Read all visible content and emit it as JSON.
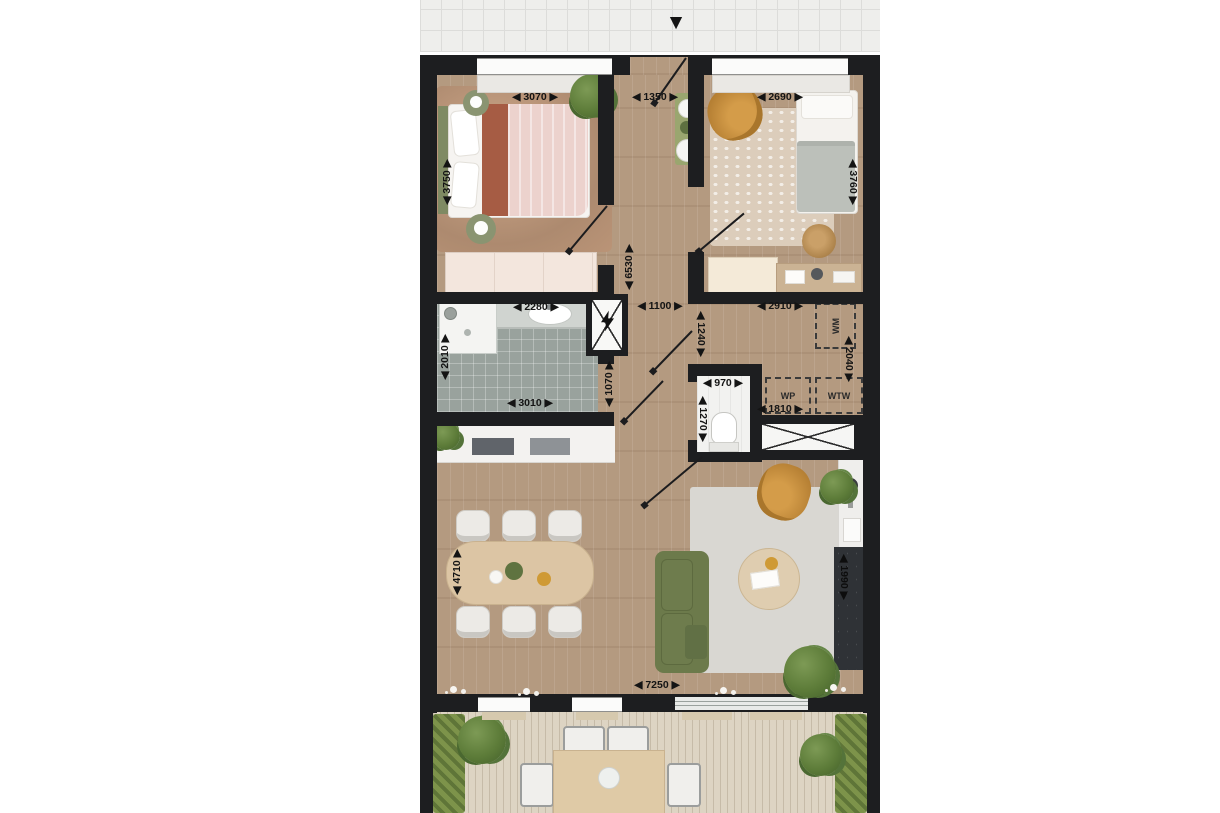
{
  "plan": {
    "entrance_arrow": "▼",
    "dims": {
      "bed1_w": "◀ 3070 ▶",
      "bed1_d": "◀ 3750 ▶",
      "hall_entry": "◀ 1350 ▶",
      "bed2_w": "◀ 2690 ▶",
      "bed2_d": "◀ 3760 ▶",
      "hall_len": "◀ 6530 ▶",
      "bath_top": "◀ 2280 ▶",
      "bath_left": "◀ 2010 ▶",
      "bath_bottom": "◀ 3010 ▶",
      "hall_w1": "◀ 1100 ▶",
      "hall_w2": "◀ 1070 ▶",
      "hall_w3": "◀ 1240 ▶",
      "wc_w": "◀ 970 ▶",
      "wc_d": "◀ 1270 ▶",
      "tech_w": "◀ 2910 ▶",
      "tech_d": "◀ 2040 ▶",
      "tech_bottom": "◀ 1810 ▶",
      "living_d": "◀ 4710 ▶",
      "living_w": "◀ 7250 ▶",
      "kitchen_len": "◀ 1990 ▶"
    },
    "appliances": {
      "wm": "WM",
      "wp": "WP",
      "wtw": "WTW"
    },
    "colors": {
      "wall": "#1d1e20",
      "wood_floor": "#b49a80",
      "bathroom_tile": "#99a29d",
      "deck": "#ddd4c3",
      "sofa_green": "#6c7a4b",
      "accent_mustard": "#c79043",
      "rug_gray": "#d9d7d2",
      "counter_dark": "#2f3236"
    }
  }
}
